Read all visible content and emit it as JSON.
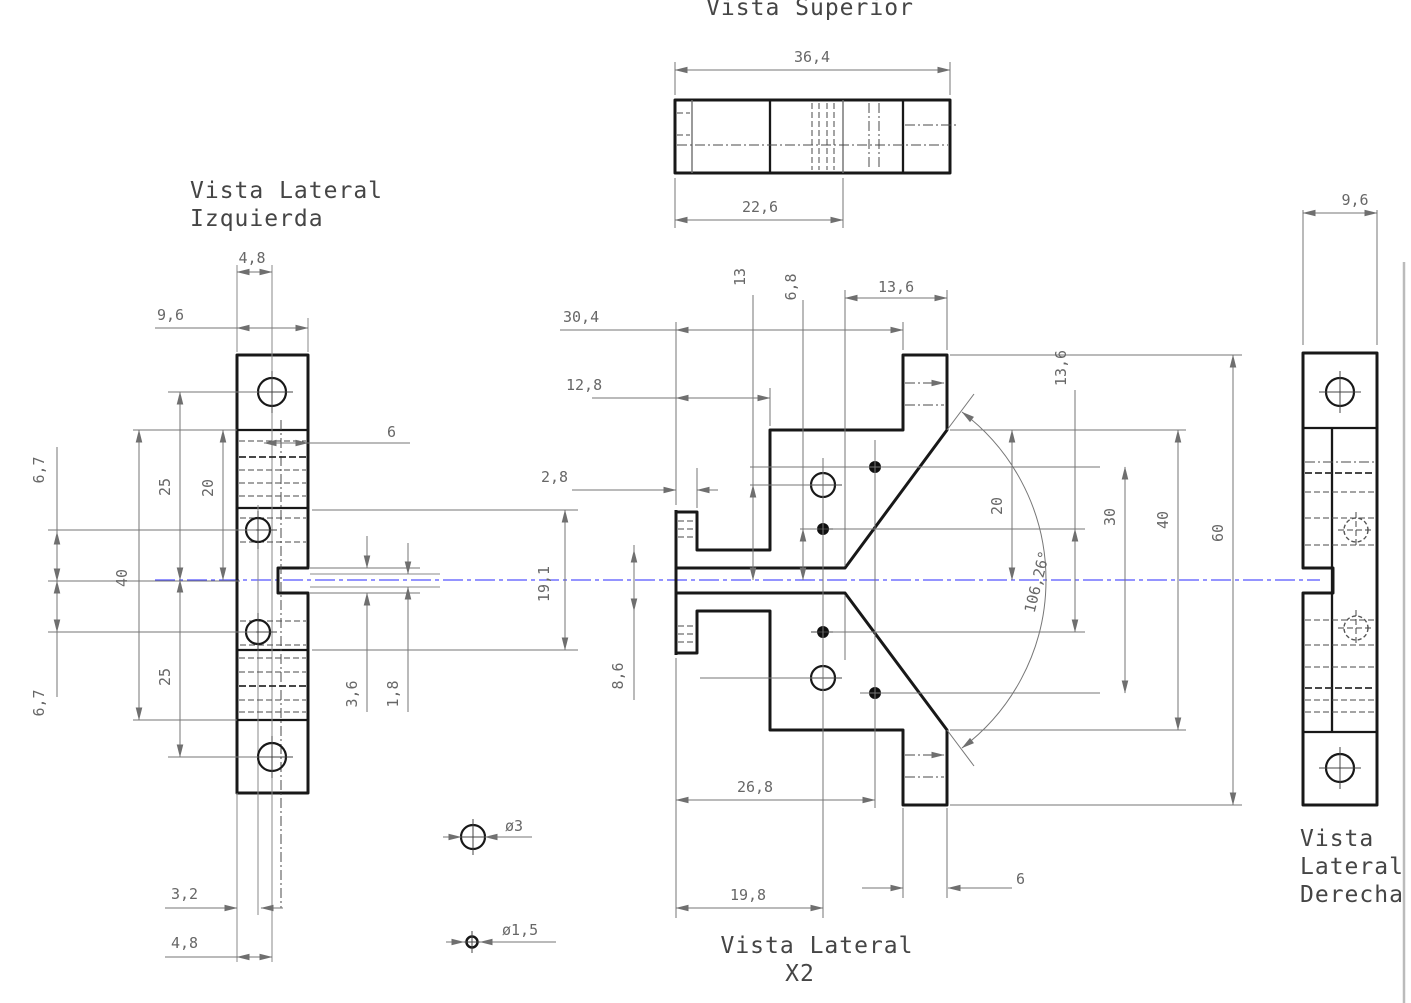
{
  "colors": {
    "outline": "#181818",
    "dim_line": "#767676",
    "dim_text": "#676767",
    "centerline_blue": "#5353ff",
    "page_edge": "#bbbbbb"
  },
  "titles": {
    "top": "Vista Superior",
    "left_line1": "Vista Lateral",
    "left_line2": "Izquierda",
    "bottom_line1": "Vista Lateral",
    "bottom_line2": "X2",
    "right_line1": "Vista",
    "right_line2": "Lateral",
    "right_line3": "Derecha"
  },
  "callouts": {
    "large_hole": "ø3",
    "small_hole": "ø1,5"
  },
  "dims": {
    "top": {
      "width": "36,4",
      "inner_width": "22,6"
    },
    "left": {
      "tab_width": "4,8",
      "width": "9,6",
      "hole_to_center_top": "6,7",
      "outer_hole_top": "25",
      "inner_span": "20",
      "body_height": "40",
      "hole_offset": "6",
      "inner_height": "19,1",
      "slot_outer": "3,6",
      "slot_inner": "1,8",
      "outer_hole_bottom": "25",
      "hole_to_center_bottom": "6,7",
      "base_offset_a": "3,2",
      "base_offset_b": "4,8"
    },
    "center": {
      "width_outer": "30,4",
      "width_step": "12,8",
      "tab_depth": "2,8",
      "hole_to_center_a": "13",
      "hole_to_center_b": "6,8",
      "flare_width": "13,6",
      "hole_span": "13,6",
      "half_height": "20",
      "hole_span_outer": "30",
      "body_height": "40",
      "total_height": "60",
      "angle": "106,26°",
      "mouth_height": "8,6",
      "width_hole_far": "26,8",
      "width_hole_near": "19,8",
      "tab_width": "6"
    },
    "right": {
      "width": "9,6"
    }
  }
}
